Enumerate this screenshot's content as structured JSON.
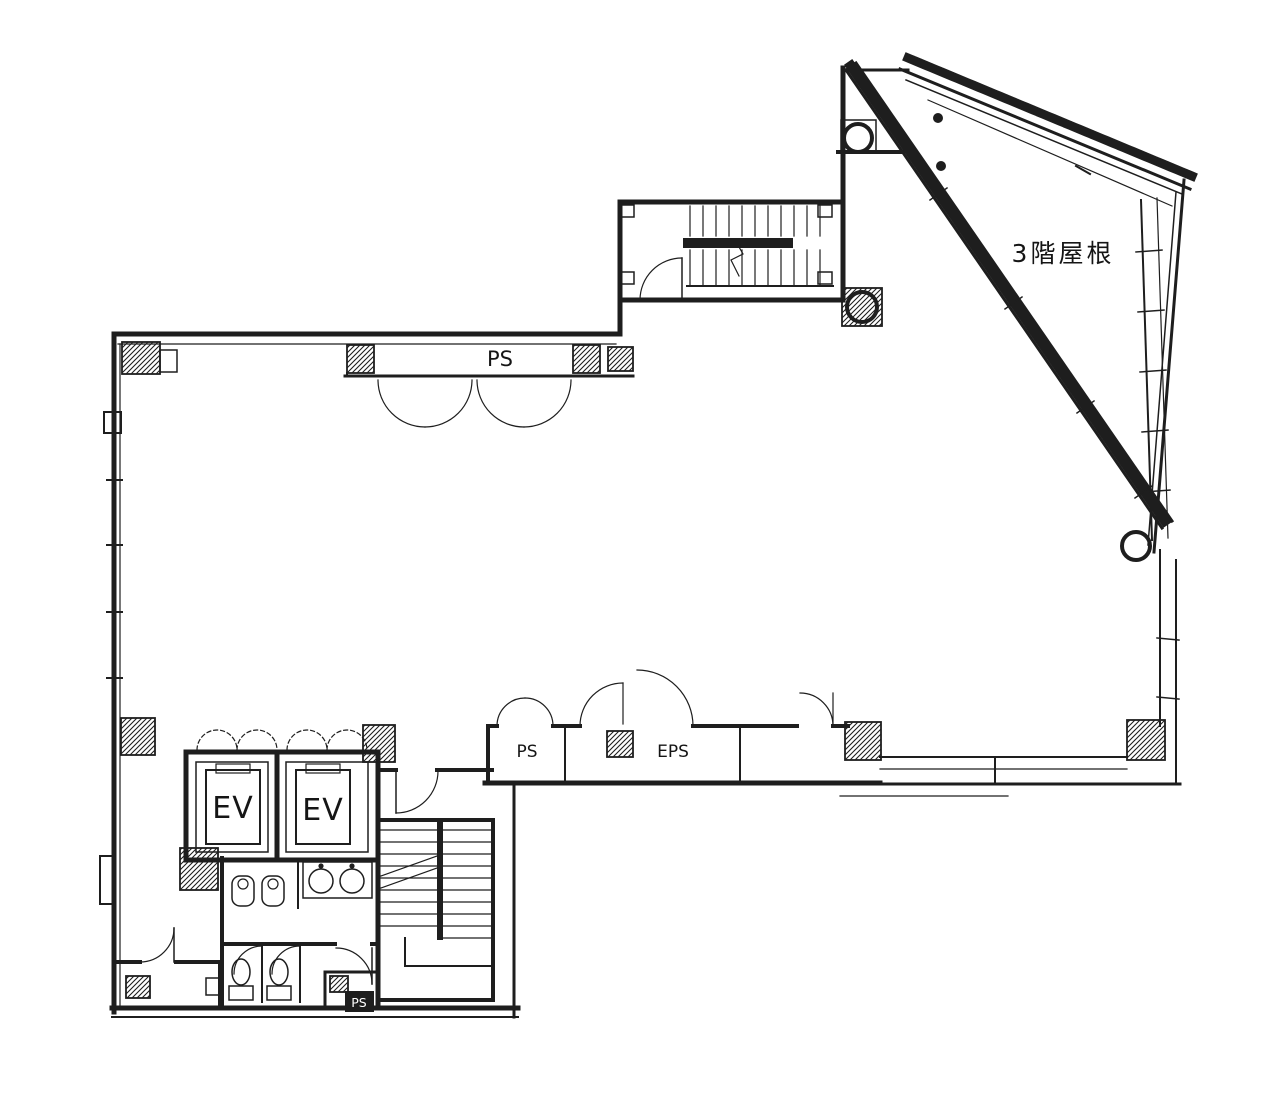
{
  "drawing": {
    "kind": "architectural-floor-plan",
    "labels": {
      "roof": "3階屋根",
      "ps_top": "PS",
      "ps_strip": "PS",
      "eps_strip": "EPS",
      "ev_left": "EV",
      "ev_right": "EV",
      "ps_toilet": "PS"
    },
    "colors": {
      "ink": "#1e1e1e",
      "paper": "#ffffff"
    }
  }
}
